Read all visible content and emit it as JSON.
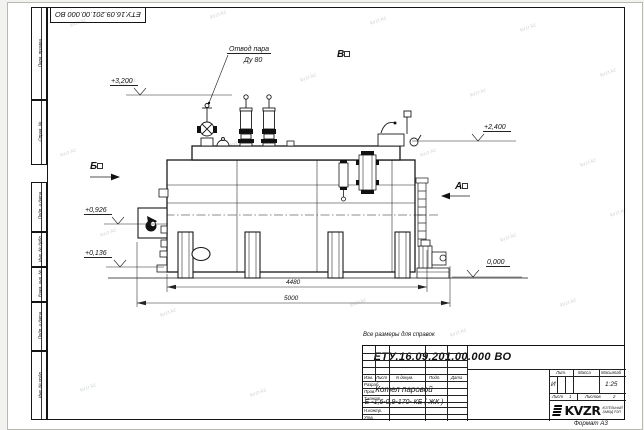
{
  "sheet": {
    "format_label": "Формат А3",
    "reference_note": "Все размеры для справок",
    "watermark": "kvzr.kz"
  },
  "stamps": {
    "top_left_docnum": "ЕТУ.16.09.201.00.000  ВО",
    "left_column": [
      "Перв. примен.",
      "Справ. №",
      "Подп. и дата",
      "Инв. № дубл.",
      "Взам. инв. №",
      "Подп. и дата",
      "Инв. № подл."
    ]
  },
  "drawing": {
    "steam_note_line1": "Отвод пара",
    "steam_note_line2": "Ду 80",
    "view_b": "Б",
    "view_v": "В",
    "view_a": "А",
    "elev_3200": "+3,200",
    "elev_2400": "+2,400",
    "elev_0926": "+0,926",
    "elev_0136": "+0,136",
    "elev_0000": "0,000",
    "dim_4480": "4480",
    "dim_5000": "5000"
  },
  "title_block": {
    "doc_number": "ЕТУ.16.09.201.00.000  ВО",
    "product_line1": "Котел паровой",
    "product_line2": "Е -1,6-0,9-170- КБ ( ЖК )",
    "col_izm": "Изм.",
    "col_list": "Лист",
    "col_doc": "N докум.",
    "col_sign": "Подп.",
    "col_date": "Дата",
    "row_razrab": "Разраб.",
    "row_prov": "Пров.",
    "row_tkontr": "Т.контр.",
    "row_nkontr": "Н.контр.",
    "row_utv": "Утв.",
    "lit_header": "Лит.",
    "mass_header": "Масса",
    "scale_header": "Масштаб",
    "lit_value": "И",
    "scale_value": "1:25",
    "sheet_label": "Лист",
    "sheet_value": "1",
    "sheets_label": "Листов",
    "sheets_value": "2",
    "logo_text": "KVZR",
    "company_line1": "КОТЕЛЬНЫЙ",
    "company_line2": "ЗАВОД РЭП"
  }
}
